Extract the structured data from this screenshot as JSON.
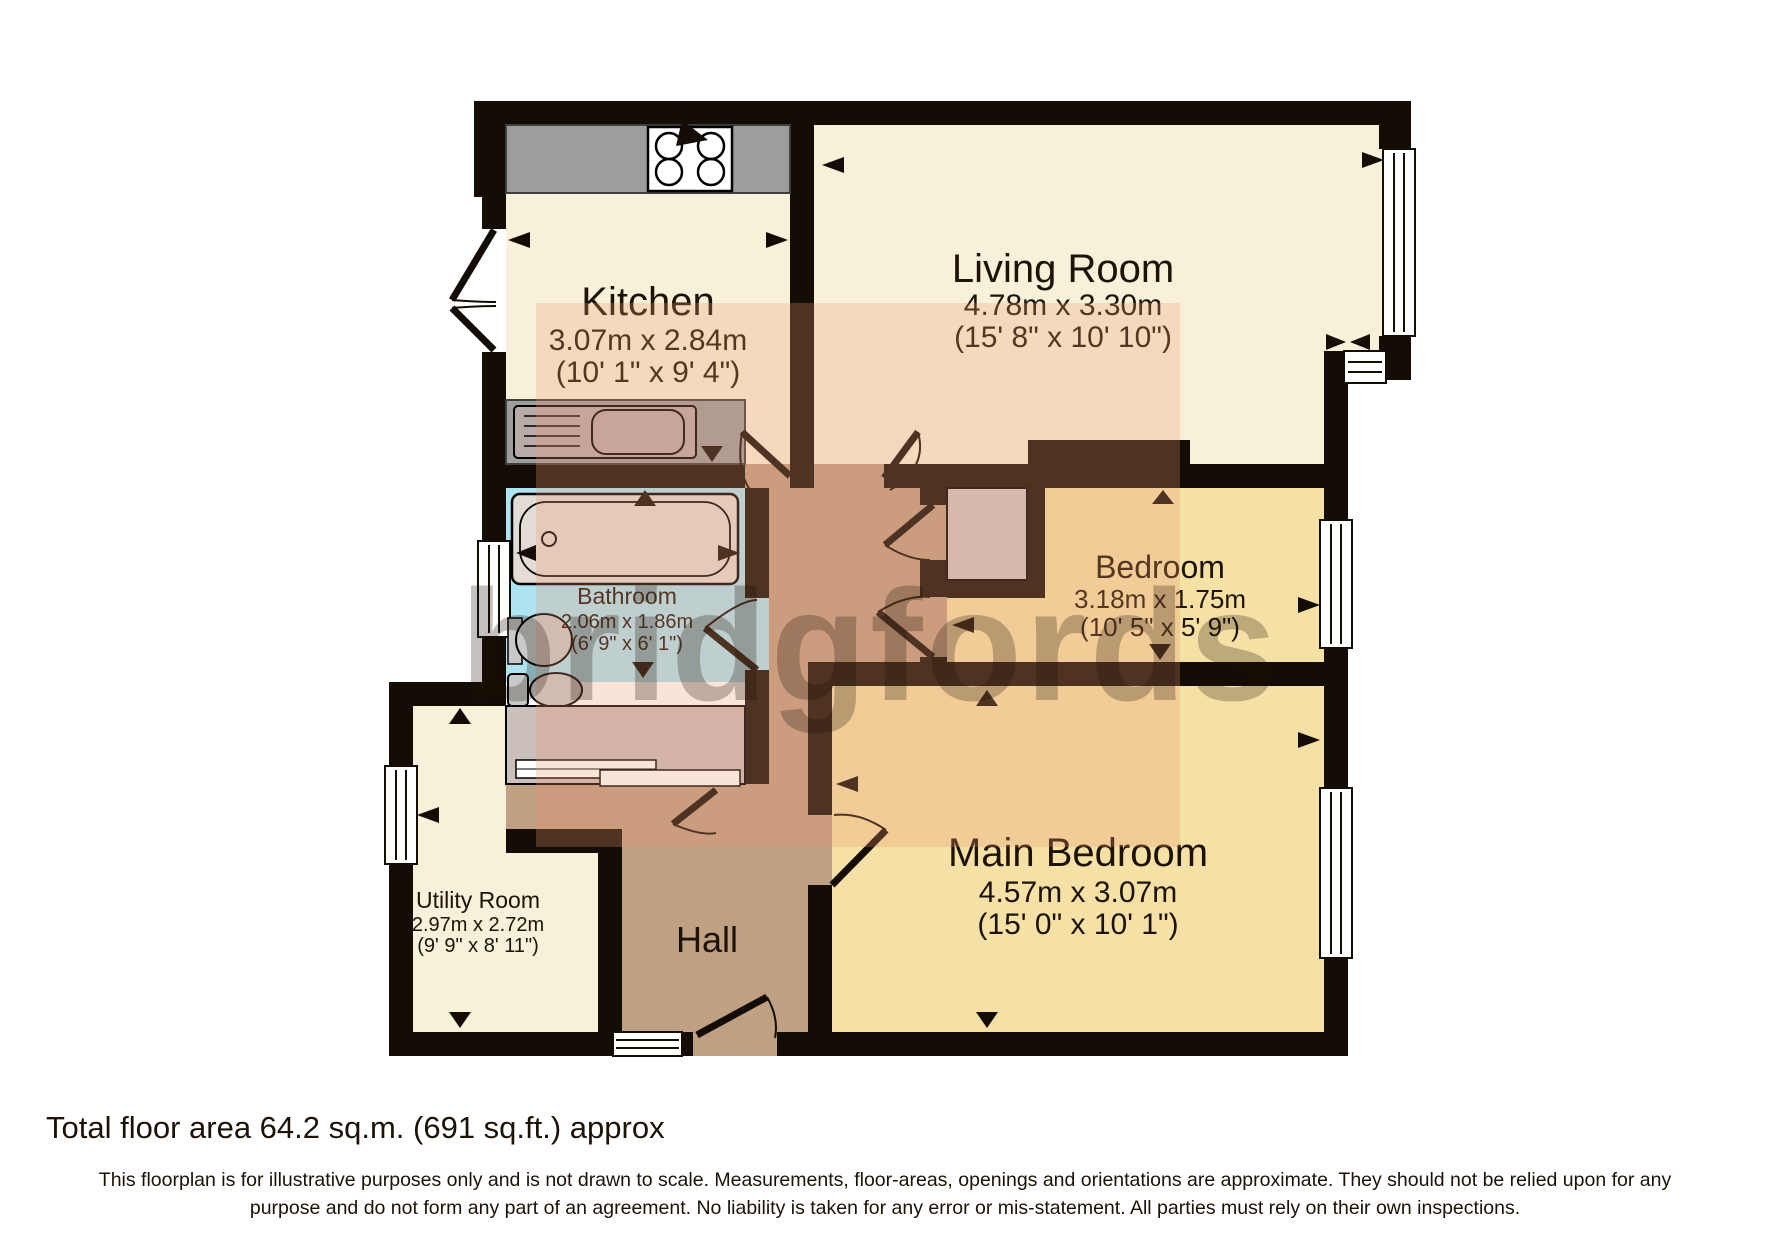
{
  "watermark_text": "bridgfords",
  "rooms": {
    "kitchen": {
      "name": "Kitchen",
      "metric": "3.07m x 2.84m",
      "imperial": "(10' 1\" x 9' 4\")"
    },
    "living_room": {
      "name": "Living Room",
      "metric": "4.78m x 3.30m",
      "imperial": "(15' 8\" x 10' 10\")"
    },
    "bathroom": {
      "name": "Bathroom",
      "metric": "2.06m x 1.86m",
      "imperial": "(6' 9\" x 6' 1\")"
    },
    "bedroom": {
      "name": "Bedroom",
      "metric": "3.18m x 1.75m",
      "imperial": "(10' 5\" x 5' 9\")"
    },
    "main_bedroom": {
      "name": "Main Bedroom",
      "metric": "4.57m x 3.07m",
      "imperial": "(15' 0\" x 10' 1\")"
    },
    "utility_room": {
      "name": "Utility Room",
      "metric": "2.97m x 2.72m",
      "imperial": "(9' 9\" x 8' 11\")"
    },
    "hall": {
      "name": "Hall"
    }
  },
  "footer": {
    "total_area": "Total floor area 64.2 sq.m. (691 sq.ft.) approx",
    "disclaimer_line1": "This floorplan is for illustrative purposes only and is not drawn to scale. Measurements, floor-areas, openings and orientations are approximate. They should not be relied upon for any",
    "disclaimer_line2": "purpose and do not form any part of an agreement. No liability is taken for any error or mis-statement. All parties must rely on their own inspections."
  },
  "colors": {
    "wall": "#140d05",
    "cream_room": "#f8f1d9",
    "bedroom_yellow": "#f5e0a5",
    "hall_brown": "#bfa083",
    "bathroom_cyan": "#aee3f2",
    "counter_gray": "#9d9d9d",
    "cupboard_gray": "#cabfbb",
    "watermark_pink": "#ec9673"
  }
}
